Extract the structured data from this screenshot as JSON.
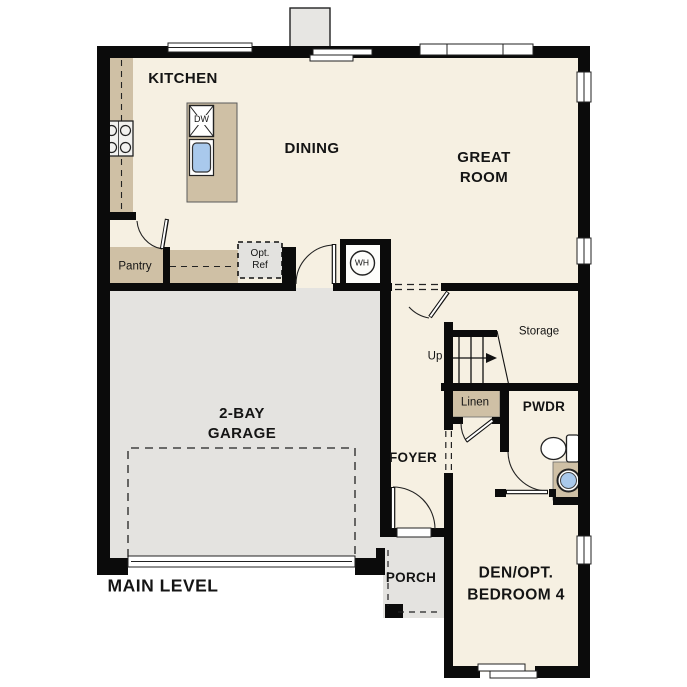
{
  "title": "MAIN LEVEL",
  "rooms": {
    "kitchen": "KITCHEN",
    "dining": "DINING",
    "great_room": "GREAT\nROOM",
    "garage": "2-BAY\nGARAGE",
    "foyer": "FOYER",
    "porch": "PORCH",
    "powder": "PWDR",
    "den": "DEN/OPT.\nBEDROOM 4",
    "storage": "Storage",
    "pantry": "Pantry",
    "linen": "Linen"
  },
  "fixtures": {
    "water_heater": "WH",
    "dishwasher": "DW",
    "optional_refrigerator": "Opt.\nRef",
    "stairs_direction": "Up"
  },
  "colors": {
    "floor": "#f6f0e2",
    "counter_tan": "#cfc0a5",
    "garage_gray": "#e4e3e0",
    "sink_blue": "#a9c9ec",
    "wall": "#0b0b0b",
    "background": "#ffffff"
  }
}
